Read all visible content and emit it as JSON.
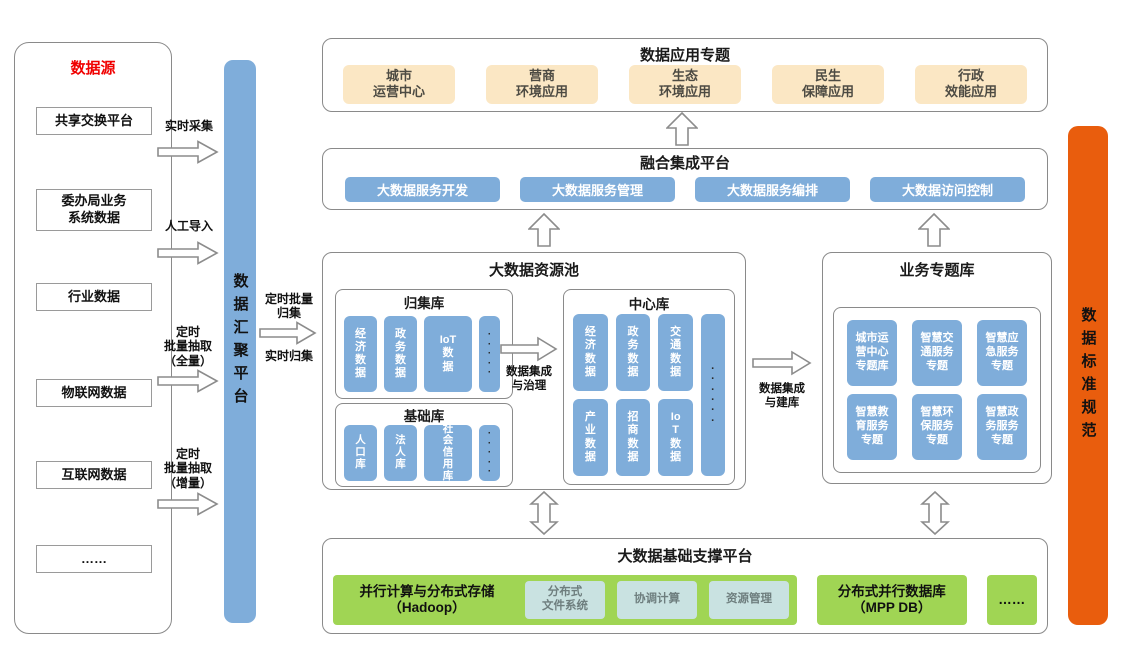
{
  "colors": {
    "blue": "#7fadda",
    "cream": "#fbe7c4",
    "green": "#a0d554",
    "teal": "#c9e2e1",
    "orange": "#e95d0d",
    "red": "#f00000"
  },
  "datasource": {
    "title": "数据源",
    "items": [
      "共享交换平台",
      "委办局业务\n系统数据",
      "行业数据",
      "物联网数据",
      "互联网数据",
      "……"
    ]
  },
  "ingest_flows": {
    "realtime": "实时采集",
    "manual": "人工导入",
    "batch_full": "定时\n批量抽取\n（全量）",
    "batch_incr": "定时\n批量抽取\n（增量）"
  },
  "hub": {
    "label": "数据汇聚平台"
  },
  "hub_flows": {
    "batch": "定时批量\n归集",
    "realtime": "实时归集"
  },
  "app_panel": {
    "title": "数据应用专题",
    "items": [
      "城市\n运营中心",
      "营商\n环境应用",
      "生态\n环境应用",
      "民生\n保障应用",
      "行政\n效能应用"
    ]
  },
  "integration_panel": {
    "title": "融合集成平台",
    "items": [
      "大数据服务开发",
      "大数据服务管理",
      "大数据服务编排",
      "大数据访问控制"
    ]
  },
  "resource_pool": {
    "title": "大数据资源池",
    "collect": {
      "title": "归集库",
      "items": [
        "经\n济\n数\n据",
        "政\n务\n数\n据",
        "IoT\n数\n据"
      ],
      "dots": "·\n·\n·\n·\n·"
    },
    "base": {
      "title": "基础库",
      "items": [
        "人\n口\n库",
        "法\n人\n库",
        "社\n会\n信\n用\n库"
      ],
      "dots": "·\n·\n·\n·\n·"
    },
    "center": {
      "title": "中心库",
      "row1": [
        "经\n济\n数\n据",
        "政\n务\n数\n据",
        "交\n通\n数\n据"
      ],
      "row2": [
        "产\n业\n数\n据",
        "招\n商\n数\n据",
        "Io\nT\n数\n据"
      ],
      "dots": "·\n·\n·\n·\n·\n·"
    }
  },
  "flow_labels": {
    "governance": "数据集成\n与治理",
    "build": "数据集成\n与建库"
  },
  "topic_panel": {
    "title": "业务专题库",
    "items": [
      "城市运营中心专题库",
      "智慧交通服务专题",
      "智慧应急服务专题",
      "智慧教育服务专题",
      "智慧环保服务专题",
      "智慧政务服务专题"
    ]
  },
  "support_panel": {
    "title": "大数据基础支撑平台",
    "hadoop": {
      "label": "并行计算与分布式存储\n（Hadoop）",
      "items": [
        "分布式\n文件系统",
        "协调计算",
        "资源管理"
      ]
    },
    "mpp": "分布式并行数据库\n（MPP DB）",
    "more": "……"
  },
  "standard_bar": {
    "label": "数据标准规范"
  }
}
